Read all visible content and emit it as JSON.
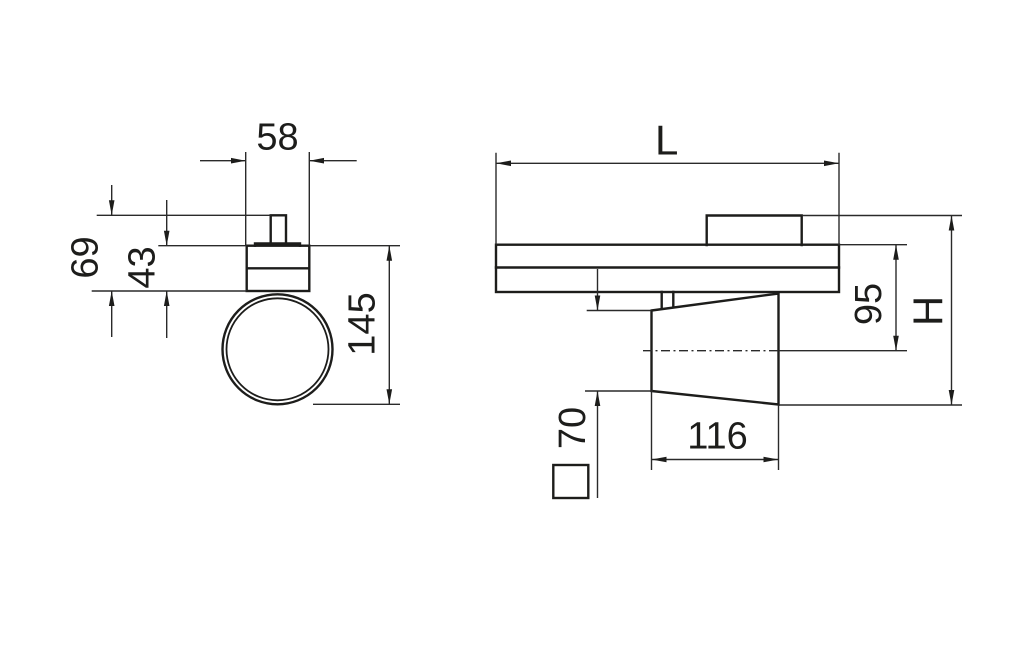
{
  "drawing": {
    "colors": {
      "background": "#ffffff",
      "line": "#1d1d1b"
    },
    "front": {
      "dim_width": "58",
      "dim_height_total": "69",
      "dim_height_body": "43",
      "dim_height_overall": "145"
    },
    "side": {
      "dim_length": "L",
      "dim_height_axis": "95",
      "dim_height_overall": "H",
      "dim_head_length": "116",
      "dim_head_size": "70"
    }
  }
}
